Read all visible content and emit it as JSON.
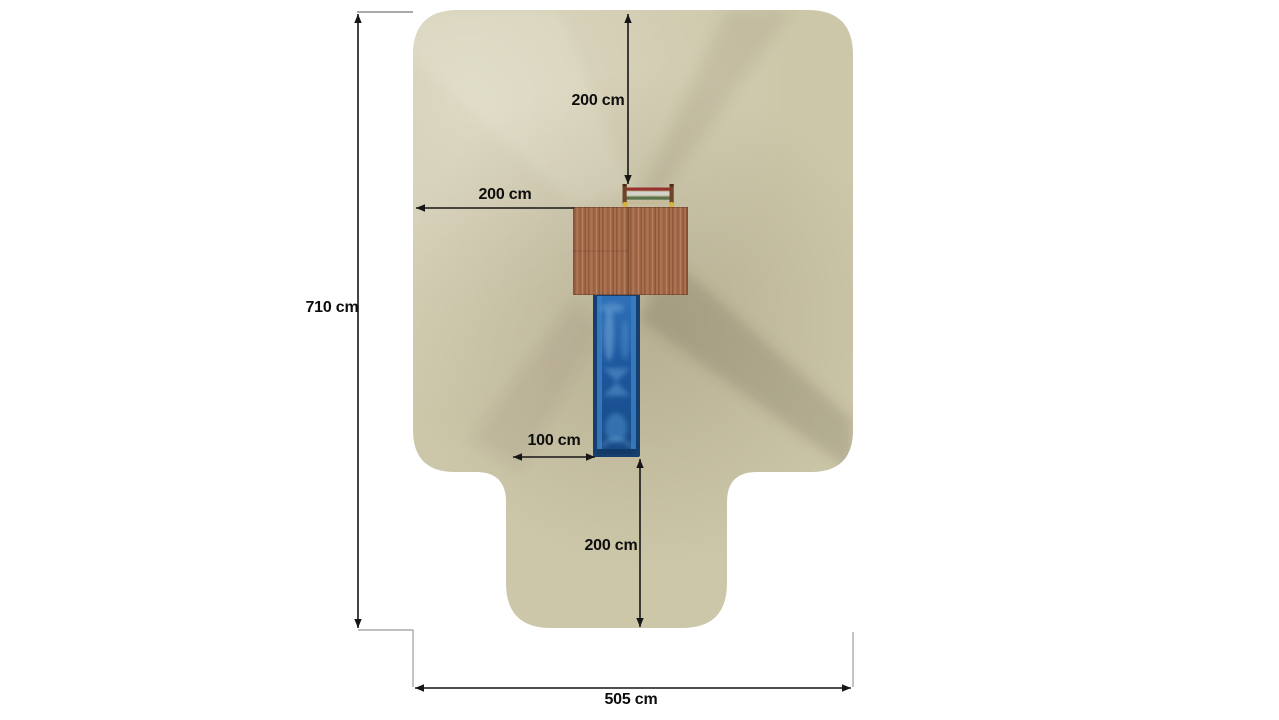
{
  "canvas": {
    "background": "#ffffff",
    "description": "Top-down installation plan of a playground unit (wooden platform, blue slide, climbing ladder) with safety-zone footprint and dimension annotations"
  },
  "colors": {
    "safety_zone": "#cdc7aa",
    "dimension_line": "#161616",
    "extension_line": "#9b9b9b",
    "label_text": "#0d0d0d",
    "platform_wood": "#a66b4b",
    "slide_frame": "#153f6f",
    "slide_bed": "#1f5ea6",
    "ladder_rail": "#6d4428",
    "ladder_rung_red": "#97312e",
    "ladder_rung_light": "#d2d4cc",
    "ladder_rung_green": "#5c744c",
    "ladder_rung_beige": "#c6ba97",
    "ladder_knob_yellow": "#d9b23a"
  },
  "diagram": {
    "view": "top view",
    "unit": "cm",
    "dimensions": {
      "top_clearance": "200 cm",
      "left_clearance": "200 cm",
      "total_depth": "710 cm",
      "slide_clearance": "100 cm",
      "bottom_clearance": "200 cm",
      "total_width": "505 cm"
    }
  }
}
